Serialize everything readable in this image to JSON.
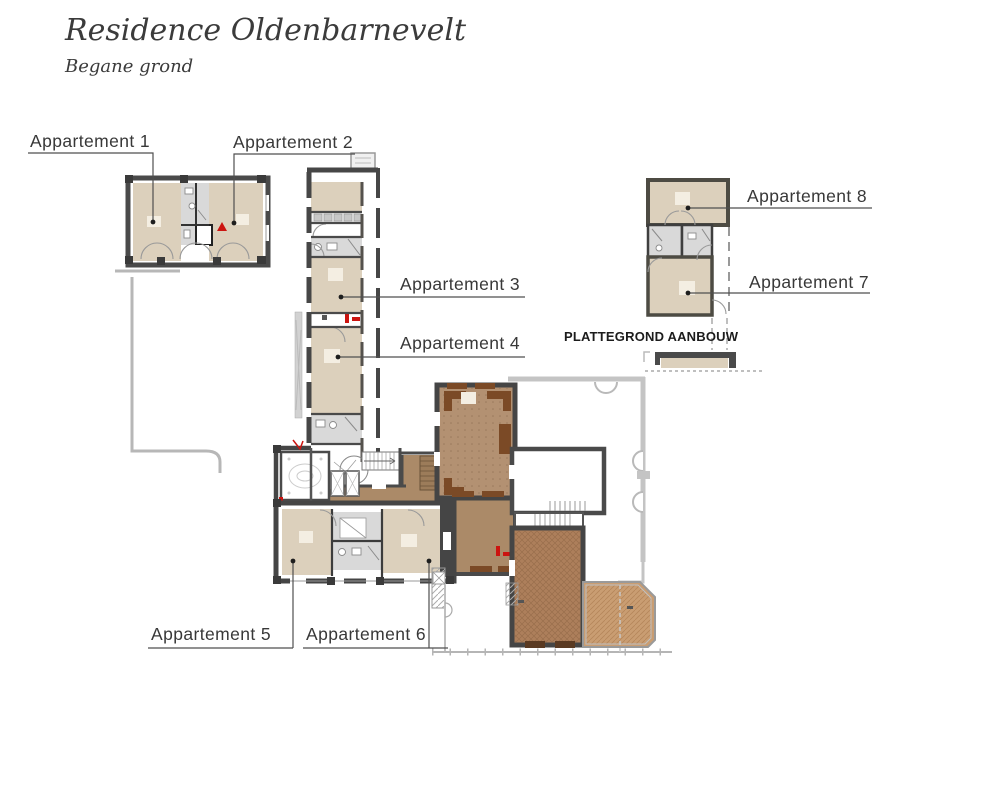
{
  "title": "Residence Oldenbarnevelt",
  "subtitle": "Begane grond",
  "apartments": [
    {
      "label": "Appartement 1"
    },
    {
      "label": "Appartement 2"
    },
    {
      "label": "Appartement 3"
    },
    {
      "label": "Appartement 4"
    },
    {
      "label": "Appartement 5"
    },
    {
      "label": "Appartement 6"
    },
    {
      "label": "Appartement 7"
    },
    {
      "label": "Appartement 8"
    }
  ],
  "annex_caption": "PLATTEGROND AANBOUW",
  "colors": {
    "room_tan": "#dcd0bc",
    "bathroom_gray": "#d9d9d9",
    "wall_dark": "#4a4a4a",
    "hall_wood_brown": "#ab8a68",
    "salon_brown": "#ad7f5b",
    "bay_brown": "#c99d72",
    "accent_dark_brown": "#7b4a26",
    "existing_outline_gray": "#c4c4c4",
    "marker_red": "#cc1410",
    "label_text": "#383838"
  }
}
